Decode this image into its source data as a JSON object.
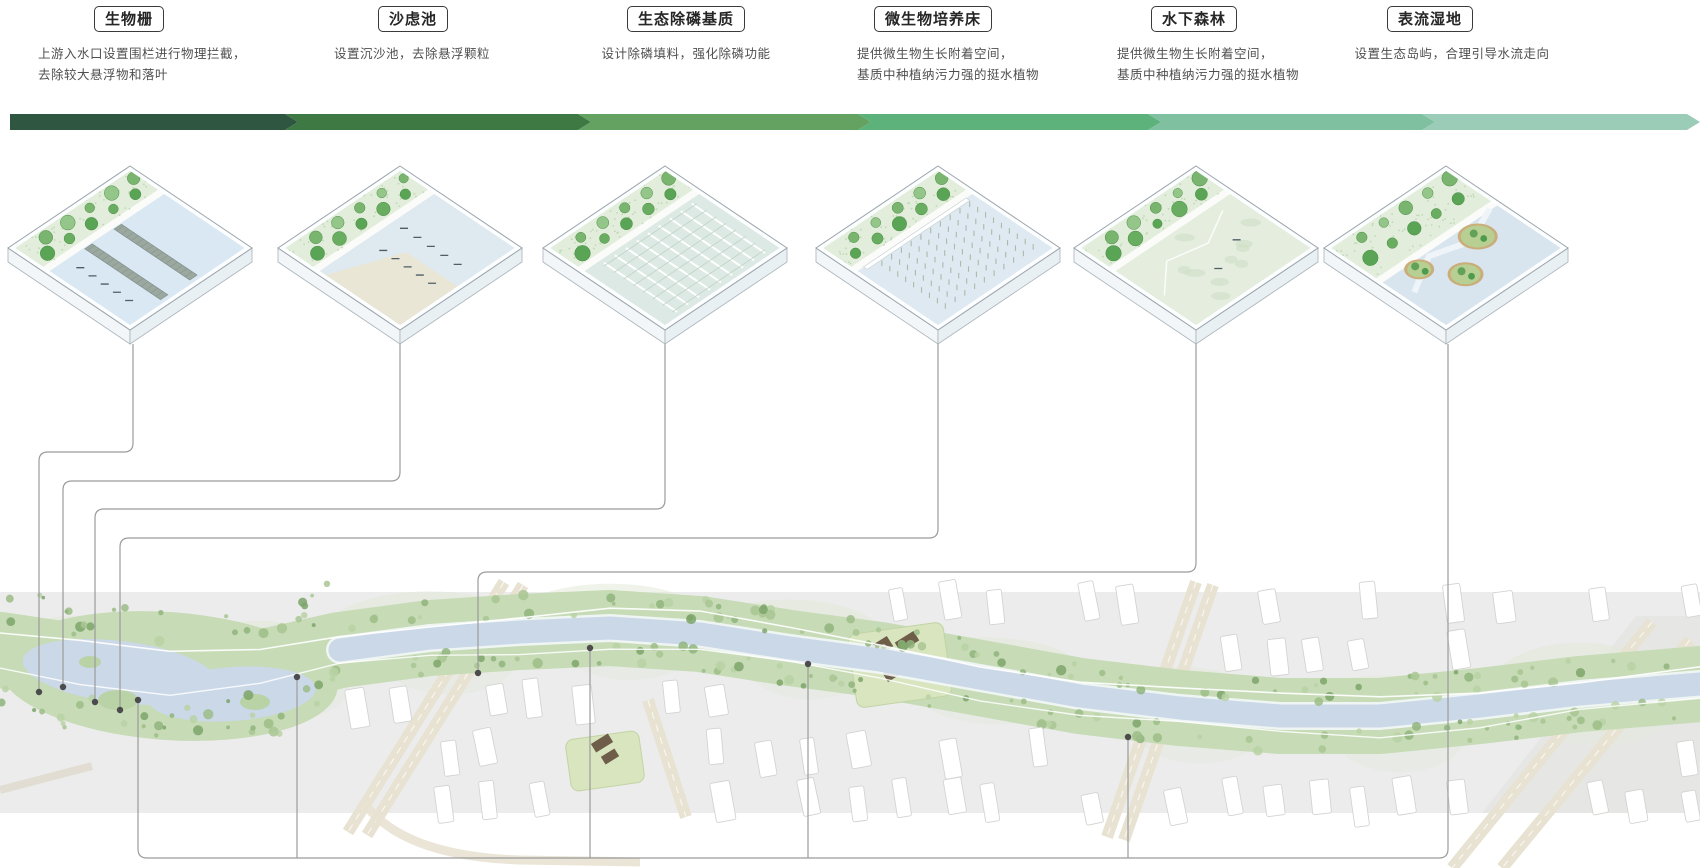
{
  "diagram_title": "河道水质净化流程 (river water purification process diagram)",
  "stages": [
    {
      "id": 1,
      "title": "生物栅",
      "desc": "上游入水口设置围栏进行物理拦截，\n去除较大悬浮物和落叶",
      "title_cx": 129,
      "desc_cx": 142,
      "cx": 130,
      "variant": "barrier",
      "leader": [
        [
          133,
          344
        ],
        [
          133,
          452
        ],
        [
          39,
          452
        ],
        [
          39,
          692
        ]
      ],
      "dot": [
        39,
        692
      ]
    },
    {
      "id": 2,
      "title": "沙虑池",
      "desc": "设置沉沙池，去除悬浮颗粒",
      "title_cx": 413,
      "desc_cx": 412,
      "cx": 400,
      "variant": "sand",
      "leader": [
        [
          400,
          344
        ],
        [
          400,
          481
        ],
        [
          63,
          481
        ],
        [
          63,
          687
        ]
      ],
      "dot": [
        63,
        687
      ]
    },
    {
      "id": 3,
      "title": "生态除磷基质",
      "desc": "设计除磷填料，强化除磷功能",
      "title_cx": 686,
      "desc_cx": 686,
      "cx": 665,
      "variant": "grid",
      "leader": [
        [
          665,
          344
        ],
        [
          665,
          509
        ],
        [
          95,
          509
        ],
        [
          95,
          702
        ]
      ],
      "dot": [
        95,
        702
      ]
    },
    {
      "id": 4,
      "title": "微生物培养床",
      "desc": "提供微生物生长附着空间，\n基质中种植纳污力强的挺水植物",
      "title_cx": 933,
      "desc_cx": 948,
      "cx": 938,
      "variant": "reeds",
      "leader": [
        [
          938,
          344
        ],
        [
          938,
          538
        ],
        [
          120,
          538
        ],
        [
          120,
          710
        ]
      ],
      "dot": [
        120,
        710
      ]
    },
    {
      "id": 5,
      "title": "水下森林",
      "desc": "提供微生物生长附着空间，\n基质中种植纳污力强的挺水植物",
      "title_cx": 1194,
      "desc_cx": 1208,
      "cx": 1196,
      "variant": "forest",
      "leader": [
        [
          1196,
          344
        ],
        [
          1196,
          572
        ],
        [
          478,
          572
        ],
        [
          478,
          673
        ]
      ],
      "dot": [
        478,
        673
      ]
    },
    {
      "id": 6,
      "title": "表流湿地",
      "desc": "设置生态岛屿，合理引导水流走向",
      "title_cx": 1430,
      "desc_cx": 1452,
      "cx": 1446,
      "variant": "wetland",
      "leader": [
        [
          1448,
          344
        ],
        [
          1448,
          858
        ],
        [
          138,
          858
        ],
        [
          138,
          700
        ]
      ],
      "dot": [
        138,
        700
      ]
    }
  ],
  "flow_bar": {
    "y": 114,
    "height": 16,
    "tip": 13,
    "boundaries": [
      10,
      285,
      578,
      858,
      1148,
      1422,
      1687
    ],
    "colors": [
      "#2e5640",
      "#3e7944",
      "#63a261",
      "#5cb27a",
      "#7fc0a0",
      "#9bccb7"
    ]
  },
  "plan": {
    "band": {
      "y0": 592,
      "y1": 813,
      "color": "#ececec"
    },
    "river_color": "#cbd8e8",
    "veg_color": "#c6dbb6",
    "leader_color": "#9b9b9b",
    "dot_color": "#4c4c4c",
    "centerline": [
      [
        0,
        650
      ],
      [
        80,
        662
      ],
      [
        170,
        674
      ],
      [
        260,
        668
      ],
      [
        340,
        650
      ],
      [
        430,
        638
      ],
      [
        520,
        632
      ],
      [
        610,
        628
      ],
      [
        700,
        634
      ],
      [
        790,
        648
      ],
      [
        880,
        660
      ],
      [
        980,
        678
      ],
      [
        1080,
        696
      ],
      [
        1180,
        708
      ],
      [
        1280,
        716
      ],
      [
        1380,
        716
      ],
      [
        1480,
        706
      ],
      [
        1580,
        694
      ],
      [
        1700,
        684
      ]
    ],
    "bottom_taps": [
      [
        297,
        677
      ],
      [
        590,
        648
      ],
      [
        808,
        664
      ],
      [
        1128,
        737
      ]
    ],
    "roads": [
      [
        504,
        582,
        348,
        832
      ],
      [
        523,
        585,
        367,
        835
      ],
      [
        1213,
        585,
        1124,
        840
      ],
      [
        1196,
        582,
        1107,
        837
      ],
      [
        1652,
        622,
        1452,
        868
      ],
      [
        1690,
        640,
        1502,
        868
      ],
      [
        648,
        700,
        686,
        817
      ]
    ],
    "parks": [
      {
        "x": 852,
        "y": 628,
        "w": 96,
        "h": 74,
        "rot": -8,
        "roofs": [
          [
            866,
            642,
            26,
            12
          ],
          [
            896,
            636,
            22,
            11
          ],
          [
            884,
            668,
            18,
            10
          ]
        ]
      },
      {
        "x": 568,
        "y": 735,
        "w": 74,
        "h": 52,
        "rot": -8,
        "roofs": [
          [
            592,
            738,
            20,
            10
          ],
          [
            602,
            752,
            16,
            9
          ]
        ]
      }
    ]
  }
}
